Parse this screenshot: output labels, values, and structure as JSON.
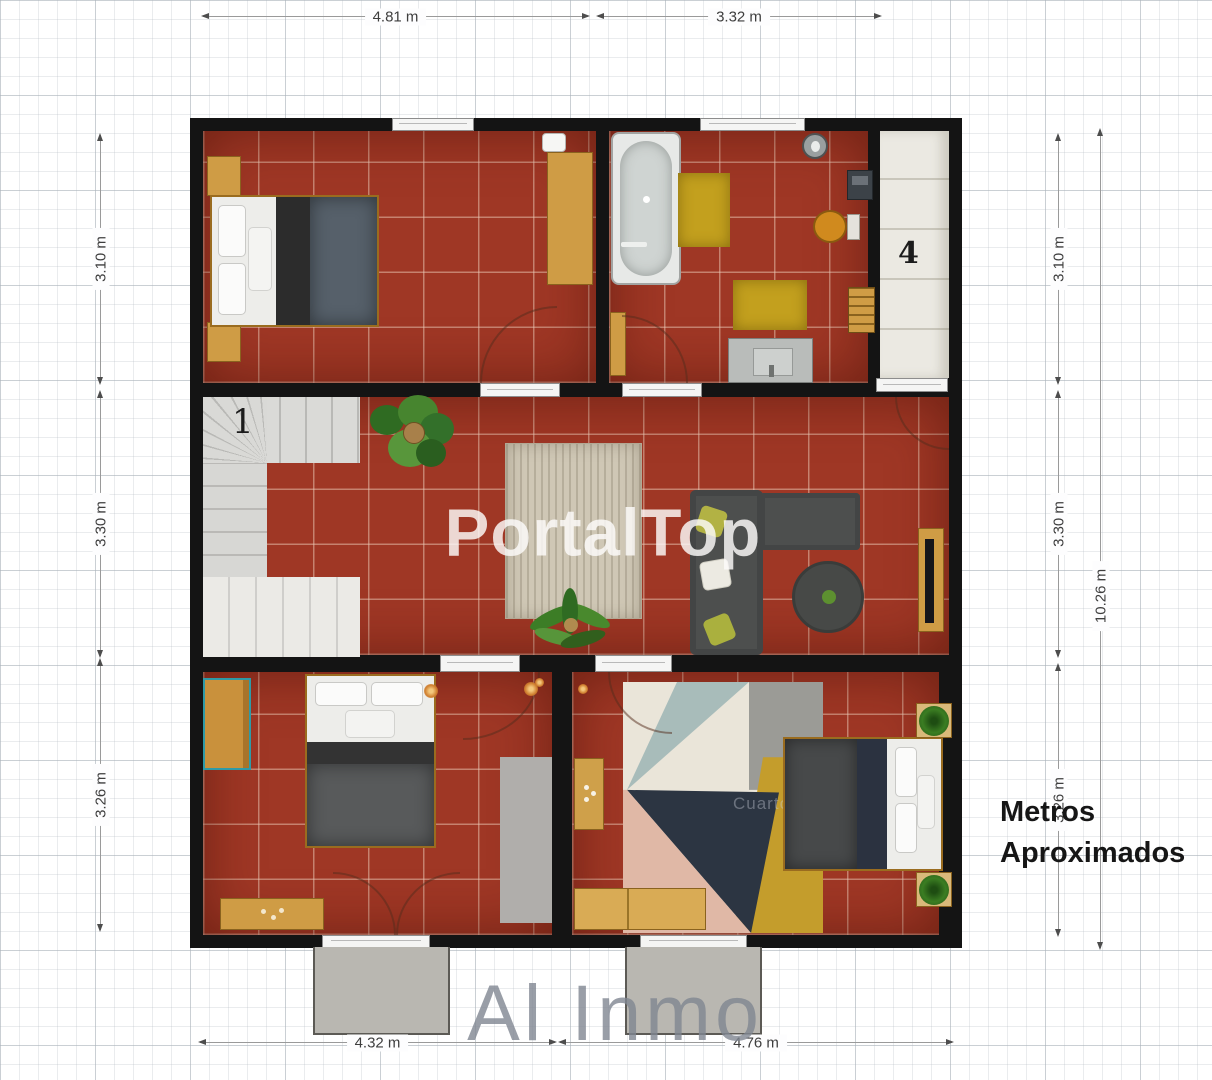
{
  "plan": {
    "room_labels": {
      "stairs": "1",
      "closet": "4",
      "bedroom_faint": "Cuarto"
    }
  },
  "dimensions": {
    "top": [
      {
        "label": "4.81 m"
      },
      {
        "label": "3.32 m"
      }
    ],
    "bottom": [
      {
        "label": "4.32 m"
      },
      {
        "label": "4.76 m"
      }
    ],
    "left": [
      {
        "label": "3.10 m"
      },
      {
        "label": "3.30 m"
      },
      {
        "label": "3.26 m"
      }
    ],
    "right": [
      {
        "label": "3.10 m"
      },
      {
        "label": "3.30 m"
      },
      {
        "label": "3.26 m"
      }
    ],
    "right_total": {
      "label": "10.26 m"
    }
  },
  "watermarks": {
    "center": "PortalTop",
    "bottom": "Al Inmo"
  },
  "note": {
    "line1": "Metros",
    "line2": "Aproximados"
  },
  "colors": {
    "floor_tile": "#9f3725",
    "wall": "#141414",
    "wood": "#cf9c45",
    "accent_teal": "#2f9aa6",
    "rug_yellow": "#c3a01e",
    "watermark_gray": "#7f8691",
    "watermark_white": "#fdfbfa"
  }
}
